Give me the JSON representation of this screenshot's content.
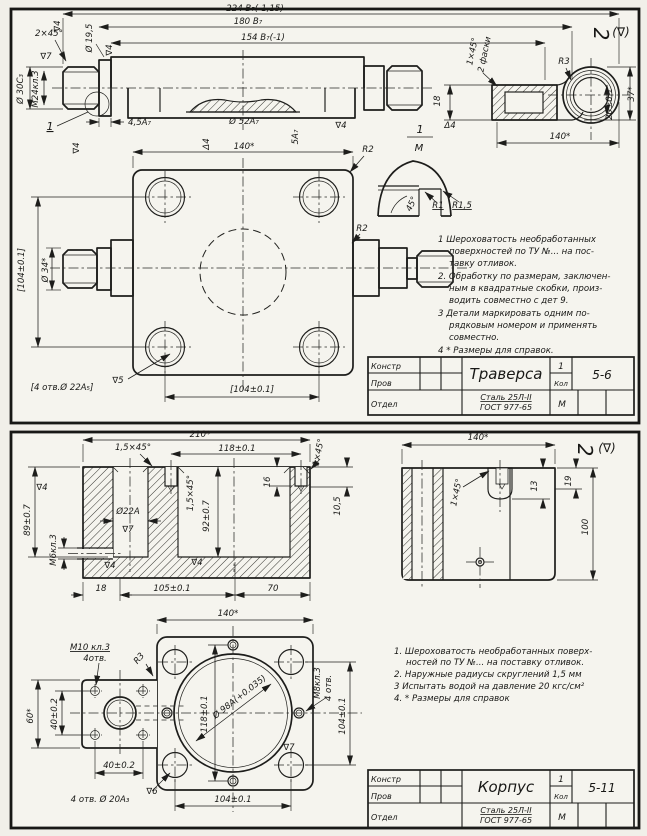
{
  "page": {
    "background": "#f1efe9",
    "paper": "#f5f4ee",
    "ink": "#1d1d1b"
  },
  "sheets": [
    {
      "name": "Траверса",
      "code": "5-6",
      "qty": "1",
      "qty_label": "Кол",
      "scale": "М",
      "material": [
        "Сталь 25Л-II",
        "ГОСТ 977-65"
      ],
      "title_rows": [
        "Констр",
        "Пров",
        "Отдел"
      ],
      "detail_label": {
        "num": "1",
        "den": "М"
      },
      "corner_mark": [
        "2",
        "(∇)"
      ],
      "notes": [
        {
          "t": "1  Шероховатость необработанных",
          "x": 438,
          "y": 242,
          "a": "start"
        },
        {
          "t": "поверхностей по ТУ №... на пос-",
          "x": 449,
          "y": 254,
          "a": "start"
        },
        {
          "t": "тавку отливок.",
          "x": 449,
          "y": 266,
          "a": "start"
        },
        {
          "t": "2. Обработку по размерам, заключен-",
          "x": 438,
          "y": 279,
          "a": "start"
        },
        {
          "t": "ным в квадратные скобки, произ-",
          "x": 449,
          "y": 291,
          "a": "start"
        },
        {
          "t": "водить совместно с дет 9.",
          "x": 449,
          "y": 303,
          "a": "start"
        },
        {
          "t": "3  Детали маркировать одним по-",
          "x": 438,
          "y": 316,
          "a": "start"
        },
        {
          "t": "рядковым номером и применять",
          "x": 449,
          "y": 328,
          "a": "start"
        },
        {
          "t": "совместно.",
          "x": 449,
          "y": 340,
          "a": "start"
        },
        {
          "t": "4  * Размеры для справок.",
          "x": 438,
          "y": 353,
          "a": "start"
        }
      ],
      "labels": [
        {
          "t": "224 В₇(-1,15)",
          "x": 255,
          "y": 11
        },
        {
          "t": "180 В₇",
          "x": 248,
          "y": 24
        },
        {
          "t": "154 В₇(-1)",
          "x": 263,
          "y": 40
        },
        {
          "t": "2×45°",
          "x": 49,
          "y": 36
        },
        {
          "t": "∇7",
          "x": 46,
          "y": 59
        },
        {
          "t": "Ø 30C₃",
          "x": 23,
          "y": 89,
          "r": -90
        },
        {
          "t": "М24кл.3",
          "x": 38,
          "y": 89,
          "r": -90
        },
        {
          "t": "Ø 19,5",
          "x": 92,
          "y": 38,
          "r": -90
        },
        {
          "t": "∇4",
          "x": 60,
          "y": 26,
          "r": -90
        },
        {
          "t": "∇4",
          "x": 112,
          "y": 50,
          "r": -90
        },
        {
          "t": "4,5A₇",
          "x": 128,
          "y": 125,
          "a": "start"
        },
        {
          "t": "1",
          "x": 50,
          "y": 130,
          "u": 1,
          "s": 11
        },
        {
          "t": "∇4",
          "x": 79,
          "y": 148,
          "r": -90
        },
        {
          "t": "Ø 52A₇",
          "x": 244,
          "y": 124
        },
        {
          "t": "Δ4",
          "x": 209,
          "y": 144,
          "r": -90
        },
        {
          "t": "5A₇",
          "x": 298,
          "y": 137,
          "r": -90
        },
        {
          "t": "∇4",
          "x": 341,
          "y": 128
        },
        {
          "t": "140*",
          "x": 244,
          "y": 149
        },
        {
          "t": "R2",
          "x": 368,
          "y": 152
        },
        {
          "t": "R2",
          "x": 362,
          "y": 231
        },
        {
          "t": "[104±0.1]",
          "x": 24,
          "y": 270,
          "r": -90
        },
        {
          "t": "Ø 34*",
          "x": 48,
          "y": 270,
          "r": -90
        },
        {
          "t": "[4 отв.Ø 22A₅]",
          "x": 62,
          "y": 390
        },
        {
          "t": "∇5",
          "x": 118,
          "y": 383
        },
        {
          "t": "[104±0.1]",
          "x": 252,
          "y": 392
        },
        {
          "t": "1",
          "x": 420,
          "y": 133,
          "s": 11
        },
        {
          "t": "М",
          "x": 419,
          "y": 151,
          "s": 10
        },
        {
          "t": "45°",
          "x": 414,
          "y": 205,
          "r": -65
        },
        {
          "t": "R1",
          "x": 438,
          "y": 208,
          "u": 1
        },
        {
          "t": "R1,5",
          "x": 462,
          "y": 208,
          "u": 1
        },
        {
          "t": "1×45°",
          "x": 475,
          "y": 52,
          "r": -78
        },
        {
          "t": "2 фаски",
          "x": 487,
          "y": 55,
          "r": -78
        },
        {
          "t": "18",
          "x": 440,
          "y": 101,
          "r": -90
        },
        {
          "t": "Δ4",
          "x": 450,
          "y": 128
        },
        {
          "t": "R3",
          "x": 564,
          "y": 64
        },
        {
          "t": "37*",
          "x": 634,
          "y": 94,
          "r": -90
        },
        {
          "t": "20±0.1",
          "x": 612,
          "y": 104,
          "r": -90
        },
        {
          "t": "140*",
          "x": 560,
          "y": 139
        },
        {
          "t": "2",
          "x": 594,
          "y": 34,
          "r": 90,
          "s": 20,
          "n": "surface-finish-mark"
        },
        {
          "t": "(∇)",
          "x": 621,
          "y": 36,
          "s": 12,
          "n": "surface-finish-mark"
        }
      ],
      "title_labels": [
        {
          "bind": "title_rows.0",
          "x": 371,
          "y": 369,
          "a": "start",
          "s": 8,
          "n": "title-row-label"
        },
        {
          "bind": "title_rows.1",
          "x": 371,
          "y": 386,
          "a": "start",
          "s": 8,
          "n": "title-row-label"
        },
        {
          "bind": "title_rows.2",
          "x": 371,
          "y": 407,
          "a": "start",
          "s": 8,
          "n": "title-row-label"
        },
        {
          "bind": "name",
          "x": 506,
          "y": 379,
          "s": 15,
          "n": "part-name"
        },
        {
          "bind": "qty",
          "x": 561,
          "y": 369,
          "s": 9,
          "n": "quantity"
        },
        {
          "bind": "qty_label",
          "x": 561,
          "y": 386,
          "s": 7,
          "n": "quantity-label"
        },
        {
          "bind": "code",
          "x": 602,
          "y": 379,
          "s": 12,
          "n": "drawing-code"
        },
        {
          "bind": "material.0",
          "x": 506,
          "y": 400,
          "s": 8,
          "u": 1,
          "n": "material"
        },
        {
          "bind": "material.1",
          "x": 506,
          "y": 410,
          "s": 8,
          "n": "material-standard"
        },
        {
          "bind": "scale",
          "x": 562,
          "y": 407,
          "s": 9,
          "n": "scale"
        }
      ]
    },
    {
      "name": "Корпус",
      "code": "5-11",
      "qty": "1",
      "qty_label": "Кол",
      "scale": "М",
      "material": [
        "Сталь 25Л-II",
        "ГОСТ 977-65"
      ],
      "title_rows": [
        "Констр",
        "Пров",
        "Отдел"
      ],
      "corner_mark": [
        "2",
        "(∇)"
      ],
      "notes": [
        {
          "t": "1.  Шероховатость необработанных поверх-",
          "x": 394,
          "y": 654,
          "a": "start"
        },
        {
          "t": "ностей по ТУ №... на поставку отливок.",
          "x": 406,
          "y": 665,
          "a": "start"
        },
        {
          "t": "2.  Наружные радиусы скруглений 1,5 мм",
          "x": 394,
          "y": 677,
          "a": "start"
        },
        {
          "t": "3   Испытать водой на давление 20 кгс/см²",
          "x": 394,
          "y": 689,
          "a": "start"
        },
        {
          "t": "4.  * Размеры для справок",
          "x": 394,
          "y": 701,
          "a": "start"
        }
      ],
      "labels": [
        {
          "t": "210*",
          "x": 200,
          "y": 437
        },
        {
          "t": "1,5×45°",
          "x": 133,
          "y": 450
        },
        {
          "t": "118±0.1",
          "x": 237,
          "y": 451
        },
        {
          "t": "1×45°",
          "x": 321,
          "y": 453,
          "r": -78
        },
        {
          "t": "∇4",
          "x": 42,
          "y": 490
        },
        {
          "t": "89±0.7",
          "x": 30,
          "y": 520,
          "r": -90
        },
        {
          "t": "М6кл.3",
          "x": 56,
          "y": 550,
          "r": -90
        },
        {
          "t": "Ø22A",
          "x": 128,
          "y": 514
        },
        {
          "t": "∇7",
          "x": 128,
          "y": 532
        },
        {
          "t": "∇4",
          "x": 110,
          "y": 568
        },
        {
          "t": "1,5×45°",
          "x": 193,
          "y": 493,
          "r": -90
        },
        {
          "t": "92±0.7",
          "x": 209,
          "y": 516,
          "r": -90
        },
        {
          "t": "16",
          "x": 270,
          "y": 482,
          "r": -90
        },
        {
          "t": "∇4",
          "x": 197,
          "y": 565
        },
        {
          "t": "10,5",
          "x": 340,
          "y": 506,
          "r": -90
        },
        {
          "t": "18",
          "x": 101,
          "y": 591
        },
        {
          "t": "105±0.1",
          "x": 172,
          "y": 591
        },
        {
          "t": "70",
          "x": 273,
          "y": 591
        },
        {
          "t": "140*",
          "x": 228,
          "y": 616
        },
        {
          "t": "140*",
          "x": 478,
          "y": 440
        },
        {
          "t": "1×45°",
          "x": 459,
          "y": 493,
          "r": -78
        },
        {
          "t": "13",
          "x": 537,
          "y": 486,
          "r": -90
        },
        {
          "t": "19",
          "x": 571,
          "y": 481,
          "r": -90
        },
        {
          "t": "100",
          "x": 588,
          "y": 527,
          "r": -90
        },
        {
          "t": "2",
          "x": 578,
          "y": 450,
          "r": 90,
          "s": 20,
          "n": "surface-finish-mark"
        },
        {
          "t": "(∇)",
          "x": 607,
          "y": 452,
          "s": 12,
          "n": "surface-finish-mark"
        },
        {
          "t": "M10 кл.3",
          "x": 90,
          "y": 650,
          "u": 1
        },
        {
          "t": "4отв.",
          "x": 95,
          "y": 661
        },
        {
          "t": "R3",
          "x": 141,
          "y": 660,
          "r": -50
        },
        {
          "t": "60*",
          "x": 33,
          "y": 716,
          "r": -90
        },
        {
          "t": "40±0.2",
          "x": 57,
          "y": 714,
          "r": -90
        },
        {
          "t": "40±0.2",
          "x": 119,
          "y": 768
        },
        {
          "t": "4 отв. Ø 20A₃",
          "x": 100,
          "y": 802
        },
        {
          "t": "∇6",
          "x": 152,
          "y": 794
        },
        {
          "t": "118±0.1",
          "x": 207,
          "y": 714,
          "r": -90
        },
        {
          "t": "Ø 98A(+0.035)",
          "x": 241,
          "y": 699,
          "r": -38
        },
        {
          "t": "∇7",
          "x": 289,
          "y": 750
        },
        {
          "t": "М8кл.3",
          "x": 320,
          "y": 683,
          "r": -90
        },
        {
          "t": "4 отв.",
          "x": 331,
          "y": 688,
          "r": -90
        },
        {
          "t": "104±0.1",
          "x": 345,
          "y": 716,
          "r": -90
        },
        {
          "t": "104±0.1",
          "x": 233,
          "y": 802
        }
      ],
      "title_labels": [
        {
          "bind": "title_rows.0",
          "x": 371,
          "y": 782,
          "a": "start",
          "s": 8,
          "n": "title-row-label"
        },
        {
          "bind": "title_rows.1",
          "x": 371,
          "y": 799,
          "a": "start",
          "s": 8,
          "n": "title-row-label"
        },
        {
          "bind": "title_rows.2",
          "x": 371,
          "y": 820,
          "a": "start",
          "s": 8,
          "n": "title-row-label"
        },
        {
          "bind": "name",
          "x": 506,
          "y": 792,
          "s": 15,
          "n": "part-name"
        },
        {
          "bind": "qty",
          "x": 561,
          "y": 782,
          "s": 9,
          "n": "quantity"
        },
        {
          "bind": "qty_label",
          "x": 561,
          "y": 799,
          "s": 7,
          "n": "quantity-label"
        },
        {
          "bind": "code",
          "x": 602,
          "y": 792,
          "s": 12,
          "n": "drawing-code"
        },
        {
          "bind": "material.0",
          "x": 506,
          "y": 813,
          "s": 8,
          "u": 1,
          "n": "material"
        },
        {
          "bind": "material.1",
          "x": 506,
          "y": 823,
          "s": 8,
          "n": "material-standard"
        },
        {
          "bind": "scale",
          "x": 562,
          "y": 820,
          "s": 9,
          "n": "scale"
        }
      ]
    }
  ]
}
